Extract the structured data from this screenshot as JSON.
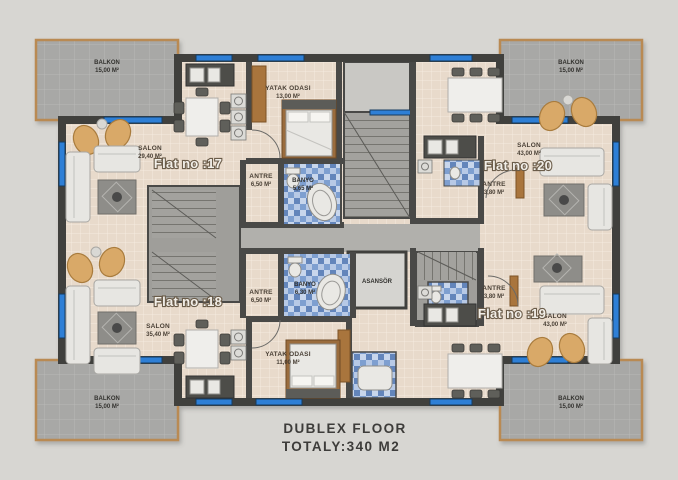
{
  "caption": {
    "line1": "DUBLEX FLOOR",
    "line2": "TOTALY:340 M2"
  },
  "watermark": "Property",
  "flats": [
    {
      "label": "Flat no :17",
      "salon_name": "SALON",
      "salon_area": "29,40 M²",
      "antre_name": "ANTRE",
      "antre_area": "6,50 M²"
    },
    {
      "label": "Flat no :18",
      "salon_name": "SALON",
      "salon_area": "35,40 M²",
      "antre_name": "ANTRE",
      "antre_area": "6,50 M²"
    },
    {
      "label": "Flat no :19",
      "salon_name": "SALON",
      "salon_area": "43,00 M²",
      "antre_name": "ANTRE",
      "antre_area": "3,80 M²"
    },
    {
      "label": "Flat no :20",
      "salon_name": "SALON",
      "salon_area": "43,00 M²",
      "antre_name": "ANTRE",
      "antre_area": "3,80 M²"
    }
  ],
  "rooms": {
    "balkon_name": "BALKON",
    "balkon_area": "15,00 M²",
    "yatak_top_name": "YATAK ODASI",
    "yatak_top_area": "13,00 M²",
    "yatak_bottom_name": "YATAK ODASI",
    "yatak_bottom_area": "11,00 M²",
    "banyo_top_name": "BANYO",
    "banyo_top_area": "5,65 M²",
    "banyo_bottom_name": "BANYO",
    "banyo_bottom_area": "6,30 M²",
    "asansor_name": "ASANSÖR"
  },
  "colors": {
    "window_blue": "#2e7fd6",
    "wall": "#403f3d",
    "floor_beige": "#e8dacb",
    "balcony_gray": "#a8a8a6",
    "wood": "#a9743c"
  }
}
